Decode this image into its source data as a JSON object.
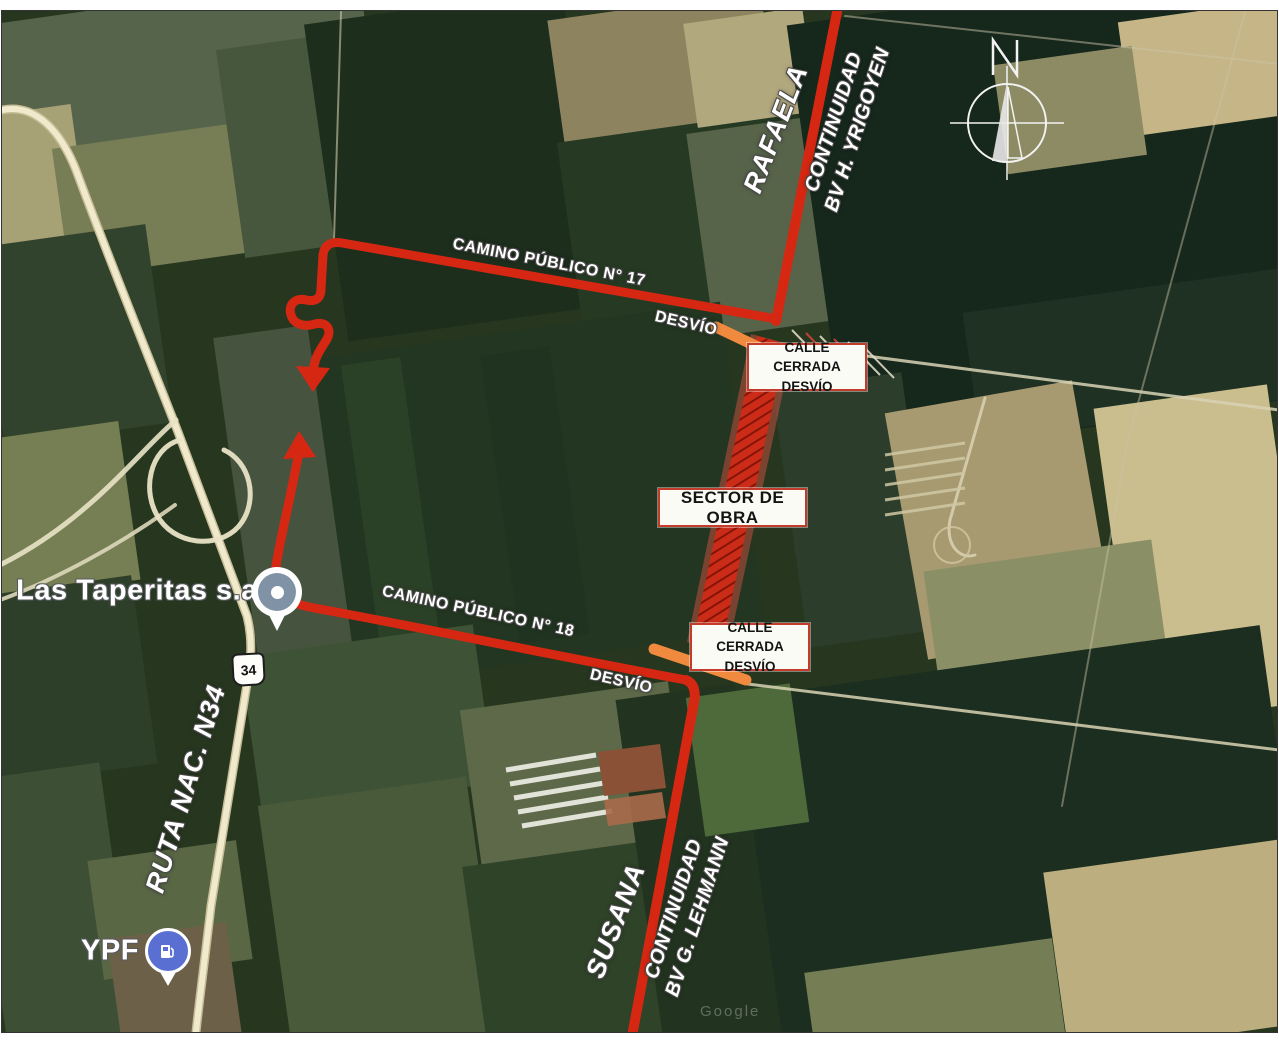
{
  "annotations": {
    "rafaela": "RAFAELA",
    "yrigoyen_line1": "CONTINUIDAD",
    "yrigoyen_line2": "BV H. YRIGOYEN",
    "camino17": "CAMINO PÚBLICO N° 17",
    "desvio_top": "DESVÍO",
    "closed_top_line1": "CALLE CERRADA",
    "closed_top_line2": "DESVÍO",
    "sector_obra": "SECTOR DE OBRA",
    "camino18": "CAMINO PÚBLICO N° 18",
    "closed_bottom_line1": "CALLE CERRADA",
    "closed_bottom_line2": "DESVÍO",
    "desvio_bottom": "DESVÍO",
    "susana": "SUSANA",
    "lehmann_line1": "CONTINUIDAD",
    "lehmann_line2": "BV G. LEHMANN",
    "ruta_nac": "RUTA NAC. N34",
    "route_shield": "34"
  },
  "places": {
    "las_taperitas": "Las Taperitas s.a",
    "ypf": "YPF"
  },
  "compass": {
    "north": "N"
  },
  "watermark": "Google",
  "colors": {
    "route_red": "#d62712",
    "work_zone_red": "#d32a16",
    "closed_orange": "#ef8a3e",
    "box_border_red": "#c43b2b",
    "label_white": "#ffffff",
    "ypf_pin_blue": "#5a6fd2",
    "taperitas_pin_grey": "#8093a6",
    "highway_pale": "#f0e9cc"
  }
}
